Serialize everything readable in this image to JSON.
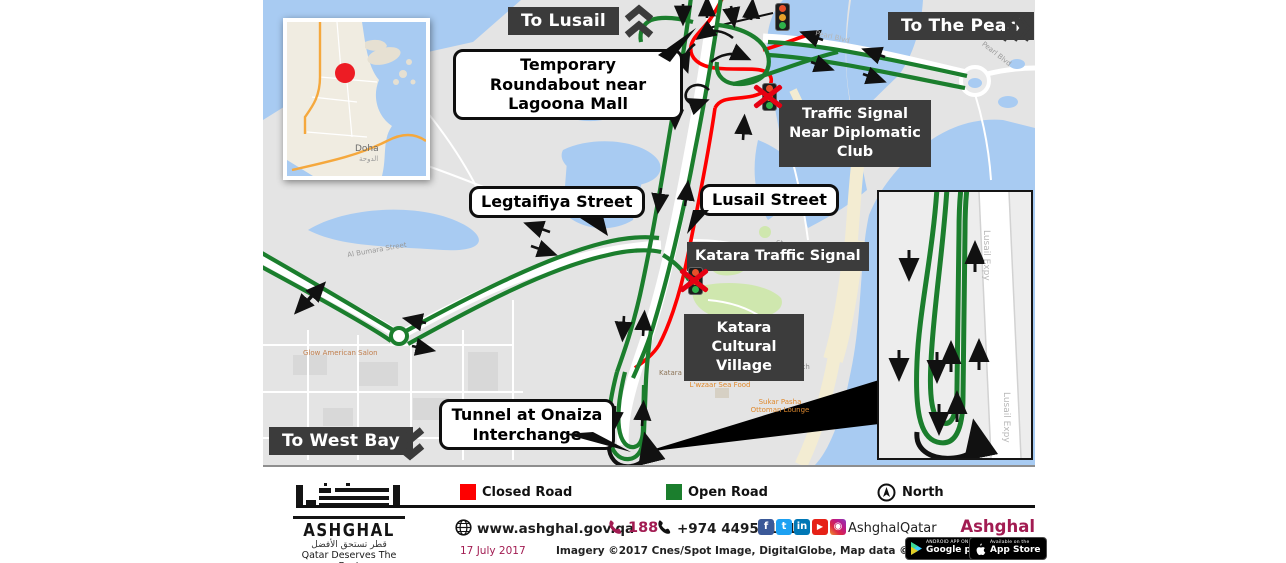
{
  "map": {
    "direction_labels": {
      "to_lusail": "To Lusail",
      "to_the_pearl": "To The Pearl",
      "to_west_bay": "To West Bay"
    },
    "callouts": {
      "temporary_roundabout": "Temporary Roundabout near Lagoona Mall",
      "legtaifiya_street": "Legtaifiya Street",
      "lusail_street": "Lusail Street",
      "tunnel_onaiza": "Tunnel at Onaiza Interchange"
    },
    "area_labels": {
      "diplomatic_signal": "Traffic Signal Near Diplomatic Club",
      "katara_signal": "Katara Traffic Signal",
      "katara_village": "Katara Cultural Village"
    },
    "basemap_labels": {
      "pearl_blvd": "Pearl Blvd",
      "lusail_expy": "Lusail Expy",
      "al_bumara_street": "Al Bumara Street",
      "glow_american_salon": "Glow American Salon",
      "shakespeare_st": "Shakespeare St",
      "katara_beach": "Katara Beach",
      "katara_pigeon_towers": "Katara Pigeon Towers",
      "lwzaar_sea_food": "L'wzaar Sea Food",
      "sukar_pasha": "Sukar Pasha Ottoman Lounge",
      "doha": "Doha",
      "doha_ar": "الدوحة"
    }
  },
  "legend": {
    "closed_road": {
      "label": "Closed Road",
      "color": "#fe0000"
    },
    "open_road": {
      "label": "Open Road",
      "color": "#1b7e2d"
    },
    "north": "North"
  },
  "footer": {
    "website": "www.ashghal.gov.qa",
    "hotline": "188",
    "phone": "+974 44951111",
    "social": {
      "handle": "AshghalQatar",
      "icons": [
        {
          "name": "facebook-icon",
          "glyph": "f"
        },
        {
          "name": "twitter-icon",
          "glyph": "t"
        },
        {
          "name": "linkedin-icon",
          "glyph": "in"
        },
        {
          "name": "youtube-icon",
          "glyph": "▶"
        },
        {
          "name": "instagram-icon",
          "glyph": "◉"
        }
      ]
    },
    "tagline": "Ashghal 24/7",
    "date": "17 July 2017",
    "credits": "Imagery ©2017 Cnes/Spot Image, DigitalGlobe, Map data ©2017 Google",
    "logo": {
      "name": "ASHGHAL",
      "tagline_ar": "قطر تستحق الأفضل",
      "tagline_en": "Qatar Deserves The Best"
    },
    "badges": {
      "google_play_top": "ANDROID APP ON",
      "google_play": "Google play",
      "app_store_top": "Available on the",
      "app_store": "App Store"
    }
  },
  "colors": {
    "accent": "#a21c52",
    "open_road": "#1b7e2d",
    "closed_road": "#fe0000"
  }
}
